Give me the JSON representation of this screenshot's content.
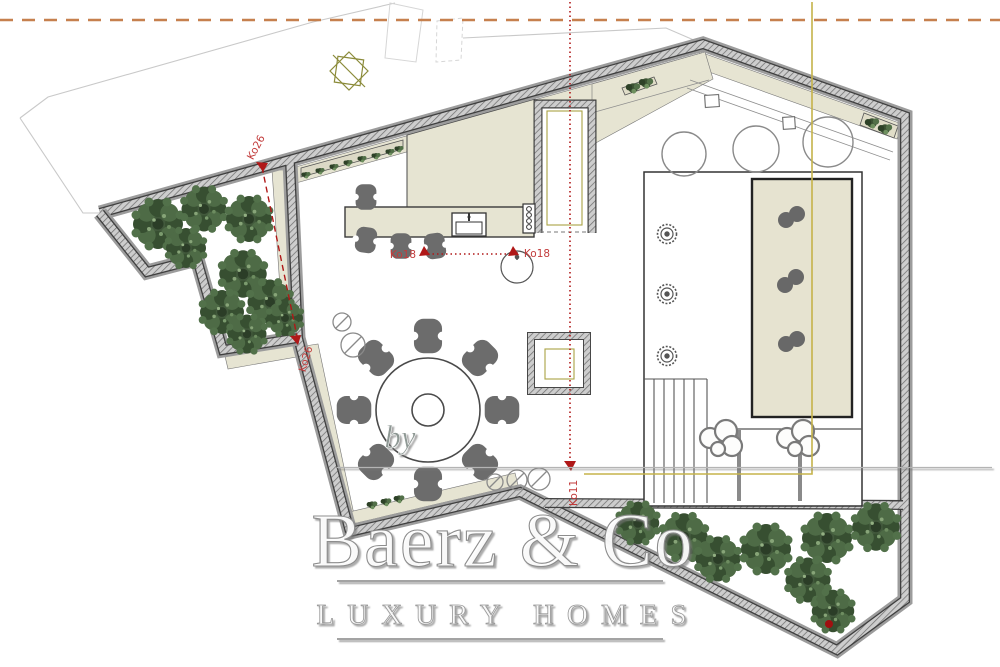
{
  "plan": {
    "watermark": {
      "by": "by",
      "brand": "Baerz & Co",
      "tagline": "LUXURY HOMES"
    },
    "dimensions": {
      "ko26": "Ko26",
      "ko18": "Ko18",
      "ko11": "Ko11"
    },
    "colors": {
      "boundary_orange": "#c6804e",
      "dimension_red": "#b01818",
      "dimension_label_red": "#c23b3b",
      "guide_yellow": "#c5b34a",
      "olive_marker": "#8b8b3a",
      "wall_dark": "#3f3f3f",
      "wall_fill": "#cdcdcd",
      "floor_beige": "#e6e4d2",
      "pool_fill": "#e6e3d0",
      "tree_green": "#42593c",
      "furniture_gray": "#6c6c6c",
      "property_line_gray": "#c9c9c9"
    }
  }
}
